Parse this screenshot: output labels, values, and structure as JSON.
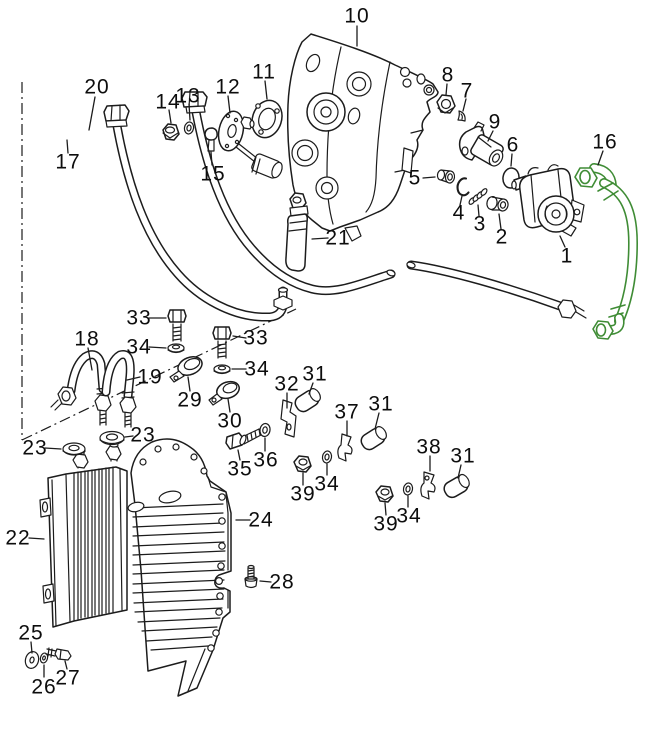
{
  "diagram": {
    "kind": "exploded-parts-diagram",
    "background": "#ffffff",
    "colors": {
      "line": "#1c1c1c",
      "label": "#0d0d0d",
      "highlight": "#3f8c35"
    },
    "highlighted_part": "16",
    "labels": [
      {
        "text": "10",
        "x": 357,
        "y": 16
      },
      {
        "text": "11",
        "x": 264,
        "y": 72
      },
      {
        "text": "12",
        "x": 228,
        "y": 87
      },
      {
        "text": "13",
        "x": 188,
        "y": 96
      },
      {
        "text": "14",
        "x": 168,
        "y": 102
      },
      {
        "text": "15",
        "x": 213,
        "y": 174
      },
      {
        "text": "20",
        "x": 97,
        "y": 87
      },
      {
        "text": "17",
        "x": 68,
        "y": 162
      },
      {
        "text": "8",
        "x": 448,
        "y": 75
      },
      {
        "text": "7",
        "x": 467,
        "y": 91
      },
      {
        "text": "9",
        "x": 495,
        "y": 122
      },
      {
        "text": "6",
        "x": 513,
        "y": 145
      },
      {
        "text": "16",
        "x": 605,
        "y": 142
      },
      {
        "text": "5",
        "x": 415,
        "y": 178
      },
      {
        "text": "4",
        "x": 459,
        "y": 213
      },
      {
        "text": "3",
        "x": 480,
        "y": 224
      },
      {
        "text": "2",
        "x": 502,
        "y": 237
      },
      {
        "text": "1",
        "x": 567,
        "y": 256
      },
      {
        "text": "21",
        "x": 338,
        "y": 238
      },
      {
        "text": "33",
        "x": 139,
        "y": 318
      },
      {
        "text": "34",
        "x": 139,
        "y": 347
      },
      {
        "text": "33",
        "x": 256,
        "y": 338
      },
      {
        "text": "34",
        "x": 257,
        "y": 369
      },
      {
        "text": "18",
        "x": 87,
        "y": 339
      },
      {
        "text": "19",
        "x": 150,
        "y": 377
      },
      {
        "text": "29",
        "x": 190,
        "y": 400
      },
      {
        "text": "30",
        "x": 230,
        "y": 421
      },
      {
        "text": "23",
        "x": 35,
        "y": 448
      },
      {
        "text": "23",
        "x": 143,
        "y": 435
      },
      {
        "text": "35",
        "x": 240,
        "y": 469
      },
      {
        "text": "36",
        "x": 266,
        "y": 460
      },
      {
        "text": "32",
        "x": 287,
        "y": 384
      },
      {
        "text": "31",
        "x": 315,
        "y": 374
      },
      {
        "text": "37",
        "x": 347,
        "y": 412
      },
      {
        "text": "31",
        "x": 381,
        "y": 404
      },
      {
        "text": "38",
        "x": 429,
        "y": 447
      },
      {
        "text": "31",
        "x": 463,
        "y": 456
      },
      {
        "text": "39",
        "x": 303,
        "y": 494
      },
      {
        "text": "34",
        "x": 327,
        "y": 484
      },
      {
        "text": "39",
        "x": 386,
        "y": 524
      },
      {
        "text": "34",
        "x": 409,
        "y": 516
      },
      {
        "text": "22",
        "x": 18,
        "y": 538
      },
      {
        "text": "24",
        "x": 261,
        "y": 520
      },
      {
        "text": "28",
        "x": 282,
        "y": 582
      },
      {
        "text": "25",
        "x": 31,
        "y": 633
      },
      {
        "text": "26",
        "x": 44,
        "y": 687
      },
      {
        "text": "27",
        "x": 68,
        "y": 678
      }
    ]
  }
}
